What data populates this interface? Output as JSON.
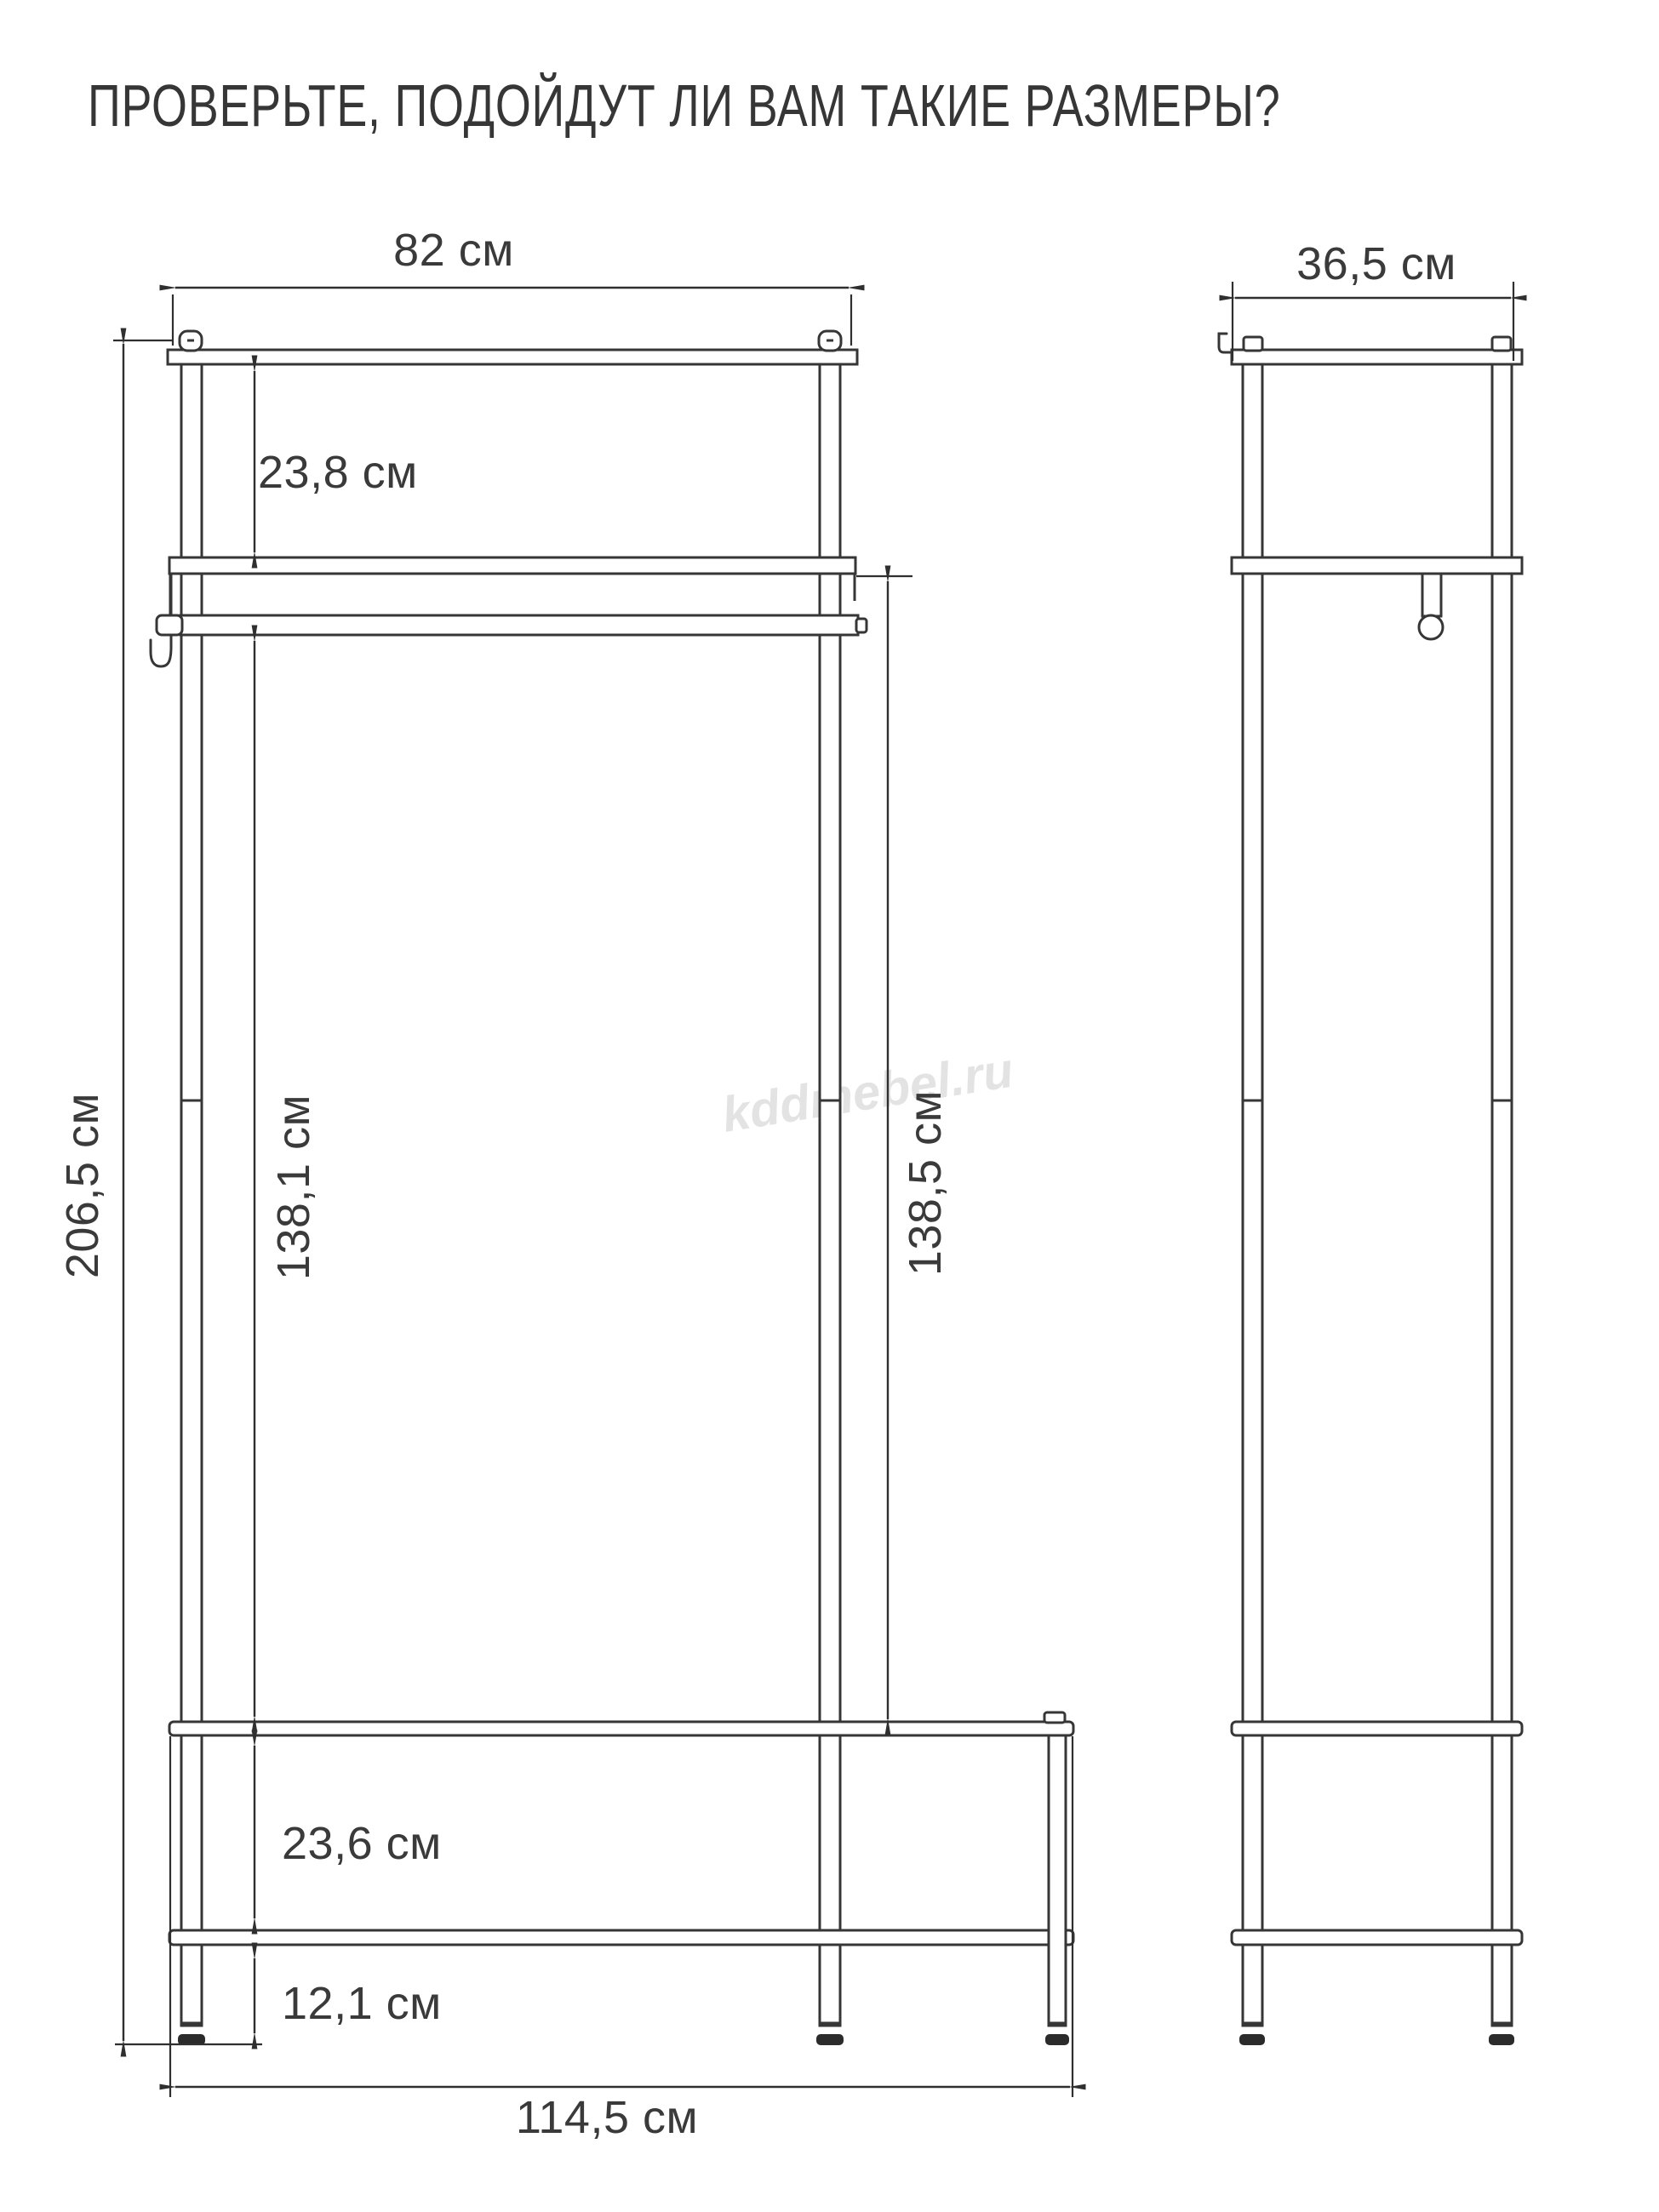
{
  "title": "ПРОВЕРЬТЕ, ПОДОЙДУТ ЛИ ВАМ ТАКИЕ РАЗМЕРЫ?",
  "watermark": "kddmebel.ru",
  "front": {
    "top_width": "82 см",
    "top_shelf_height": "23,8 см",
    "total_height": "206,5 см",
    "inner_height_left": "138,1 см",
    "inner_height_right": "138,5 см",
    "bench_clearance": "23,6 см",
    "base_clearance": "12,1 см",
    "base_width": "114,5 см"
  },
  "side": {
    "depth": "36,5 см"
  }
}
